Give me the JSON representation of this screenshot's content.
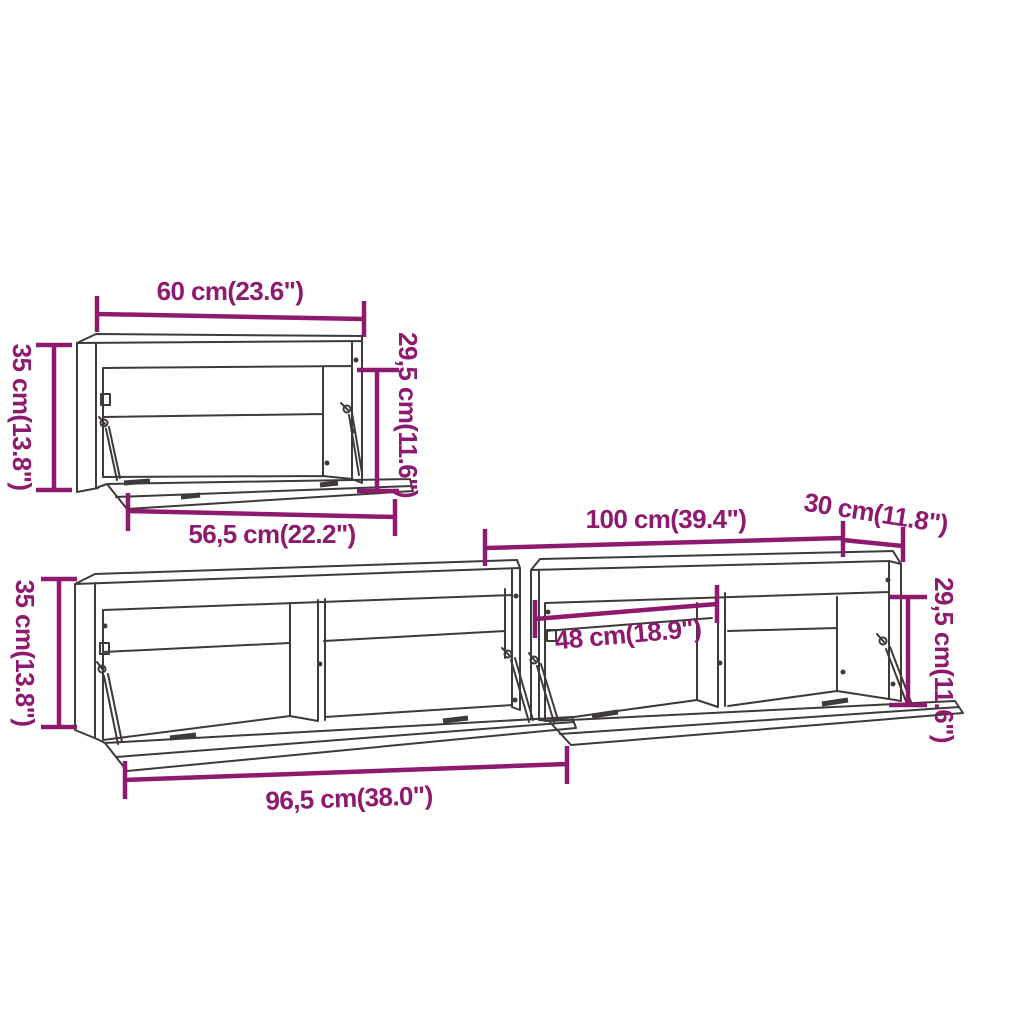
{
  "colors": {
    "background": "#ffffff",
    "outline": "#3e3a39",
    "dimension": "#8e1a6f"
  },
  "dimensions": {
    "top_cabinet": {
      "width": "60 cm(23.6\")",
      "height": "35 cm(13.8\")",
      "opening_height": "29,5 cm(11.6\")",
      "door_width": "56,5 cm(22.2\")"
    },
    "bottom_cabinets": {
      "height": "35 cm(13.8\")",
      "right_width": "100 cm(39.4\")",
      "right_depth": "30 cm(11.8\")",
      "compartment_width": "48 cm(18.9\")",
      "opening_height": "29,5 cm(11.6\")",
      "left_door_width": "96,5 cm(38.0\")"
    }
  }
}
